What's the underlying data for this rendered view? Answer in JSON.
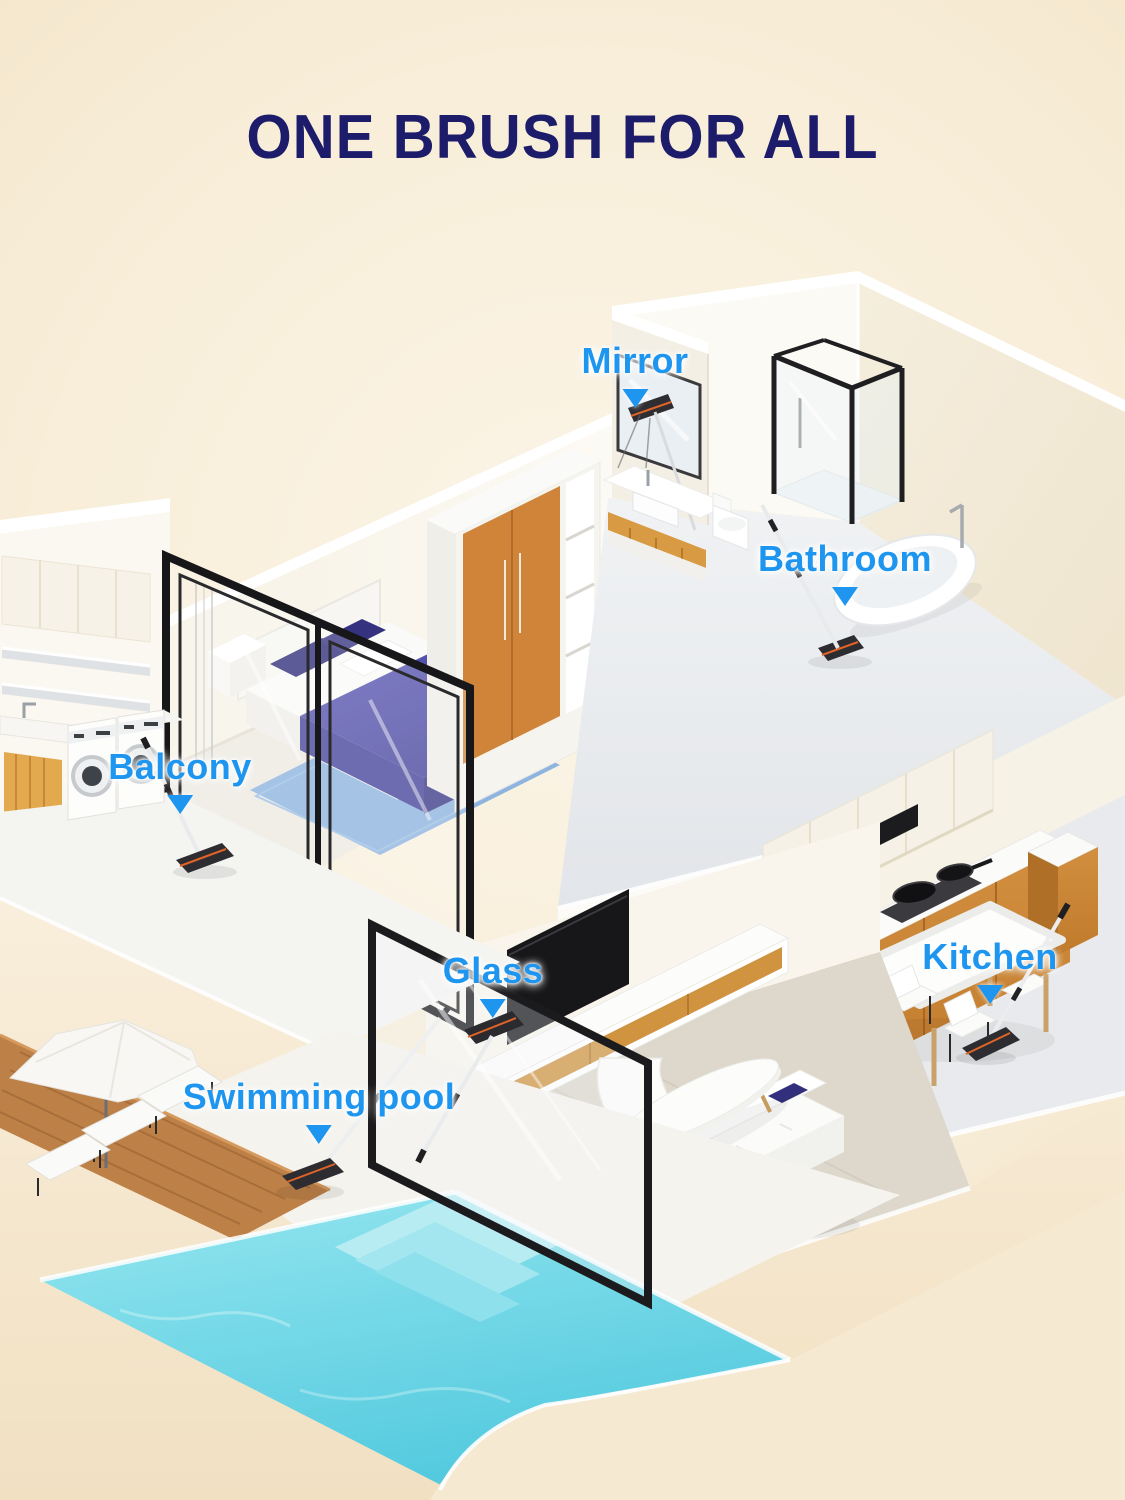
{
  "title": {
    "text": "ONE BRUSH FOR ALL"
  },
  "labels": [
    {
      "id": "mirror",
      "text": "Mirror"
    },
    {
      "id": "bathroom",
      "text": "Bathroom"
    },
    {
      "id": "balcony",
      "text": "Balcony"
    },
    {
      "id": "glass",
      "text": "Glass"
    },
    {
      "id": "kitchen",
      "text": "Kitchen"
    },
    {
      "id": "swimming-pool",
      "text": "Swimming pool"
    }
  ],
  "colors": {
    "title_navy": "#1d1c6b",
    "label_blue": "#1e96f0",
    "background_light": "#fbf4e6",
    "background_dark": "#f2e2c5",
    "wall_white": "#fbf8f1",
    "floor_gray": "#e9ecef",
    "wood_accent": "#cd8439",
    "pool_water": "#5fd2e4",
    "frame_black": "#1b1b1d",
    "bedding_blue": "#4a47a0",
    "rug_blue": "#86b0dd"
  }
}
